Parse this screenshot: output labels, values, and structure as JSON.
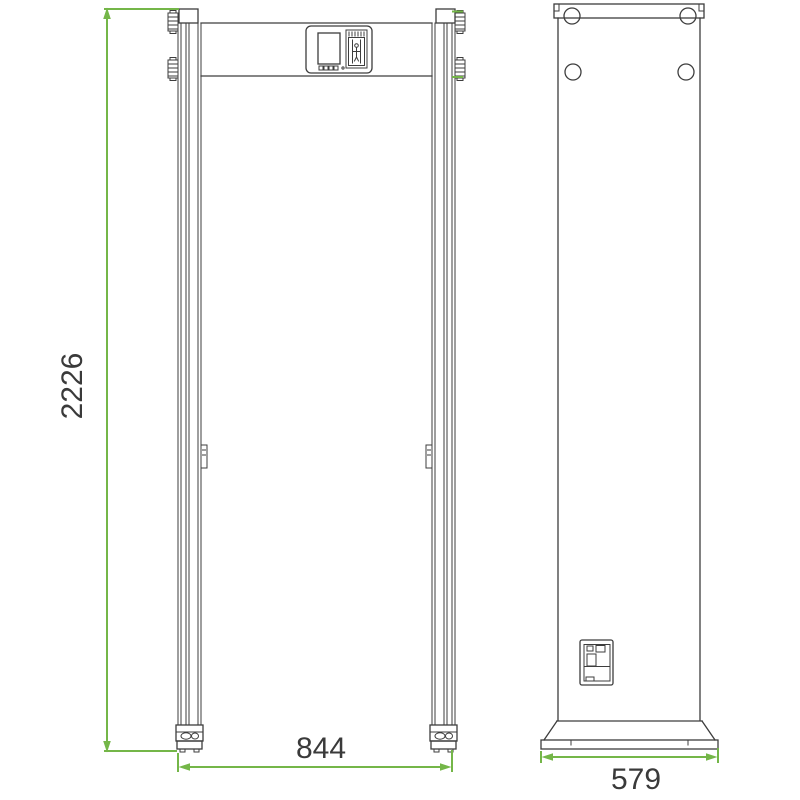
{
  "colors": {
    "background": "#ffffff",
    "outline": "#3d3d3d",
    "dimension": "#74b648",
    "text": "#3a3a3a"
  },
  "dimensions": {
    "height": "2226",
    "width": "844",
    "depth": "579"
  }
}
